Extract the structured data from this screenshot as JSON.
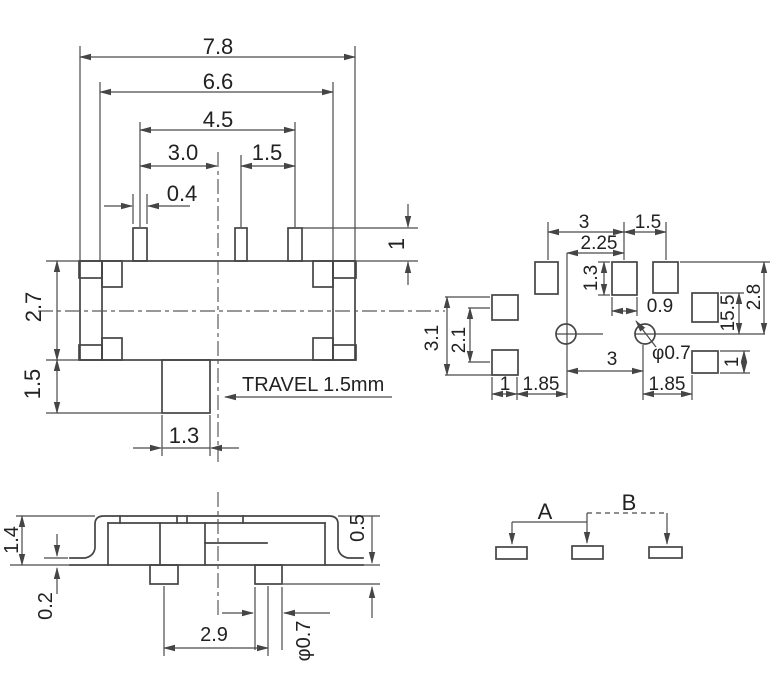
{
  "colors": {
    "line": "#454545",
    "text": "#222222",
    "background": "#ffffff"
  },
  "front_view": {
    "dim_total_width": "7.8",
    "dim_frame_width": "6.6",
    "dim_pin_span": "4.5",
    "dim_pin_pitch_left": "3.0",
    "dim_pin_pitch_right": "1.5",
    "dim_pin_width": "0.4",
    "dim_pin_height": "1",
    "dim_body_height": "2.7",
    "dim_knob_height": "1.5",
    "dim_knob_width": "1.3",
    "travel_note": "TRAVEL 1.5mm"
  },
  "footprint_view": {
    "dim_pad_pitch": "3",
    "dim_pad_pitch_right": "1.5",
    "dim_via_to_pad": "2.25",
    "dim_pad_height": "1.3",
    "dim_pad_width": "0.9",
    "dim_left_pads_span": "3.1",
    "dim_left_pads_pitch": "2.1",
    "dim_via_pitch": "3",
    "via_diameter": "φ0.7",
    "dim_right_pad_top": "15.5",
    "dim_right_span": "2.8",
    "dim_right_pad_height": "1",
    "dim_bottom_pad_width": "1",
    "dim_bottom_left": "1.85",
    "dim_bottom_right": "1.85"
  },
  "side_view": {
    "dim_height": "1.4",
    "dim_standoff": "0.2",
    "dim_peg_height": "0.5",
    "dim_peg_pitch": "2.9",
    "peg_diameter": "φ0.7"
  },
  "schematic_view": {
    "label_a": "A",
    "label_b": "B"
  }
}
